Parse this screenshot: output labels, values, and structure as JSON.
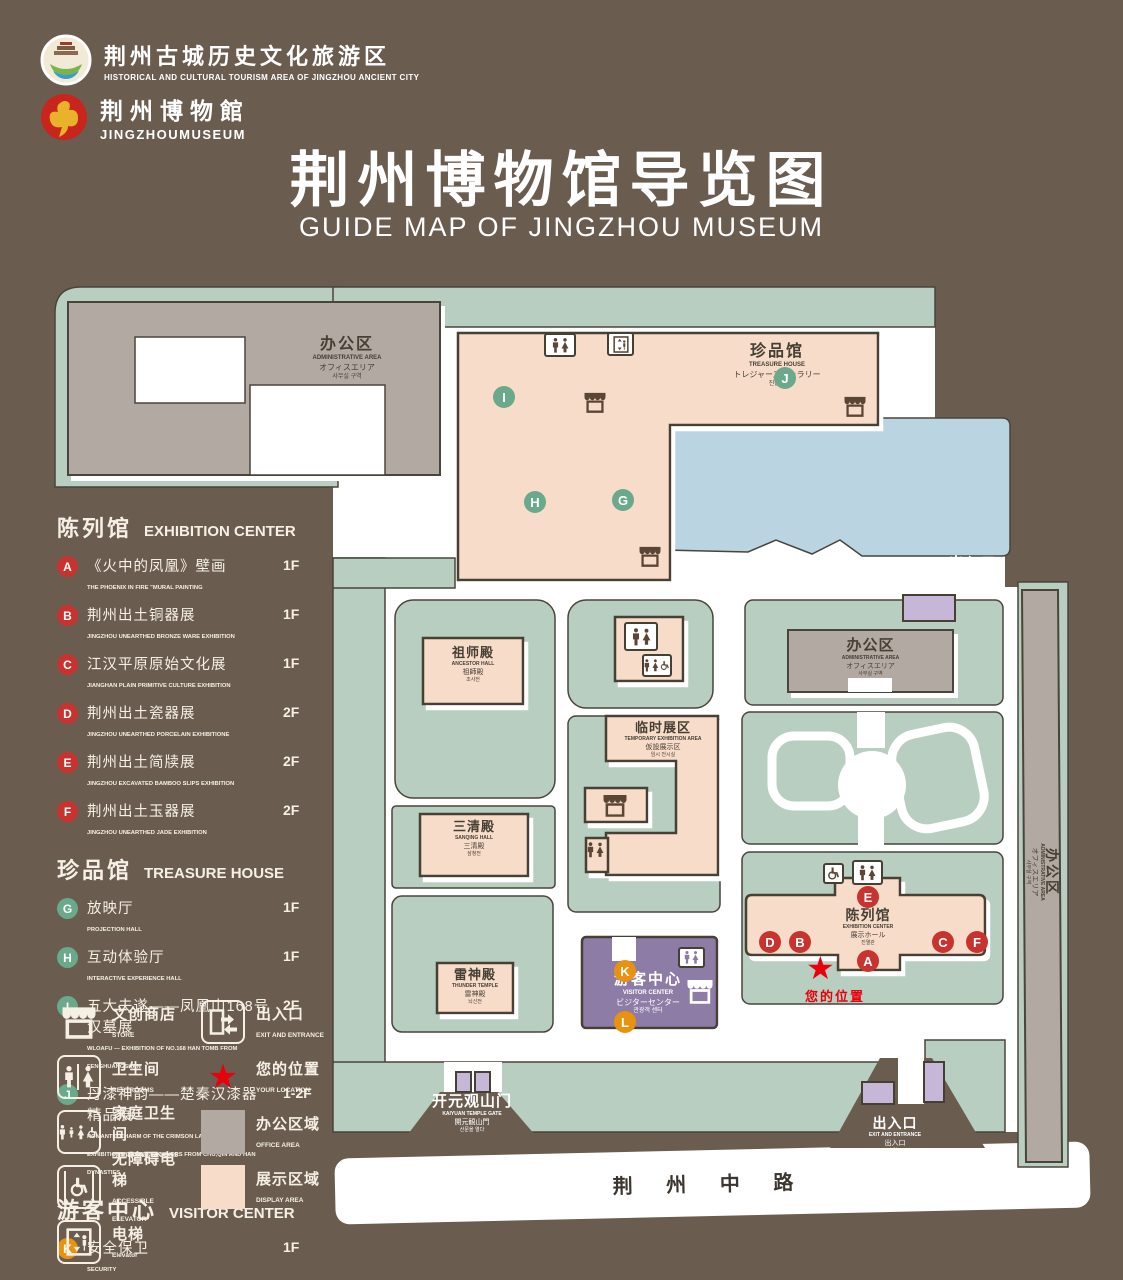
{
  "colors": {
    "background": "#6b5c50",
    "map_green": "#b7cec0",
    "display_pink": "#f8dcca",
    "office_gray": "#b2aaa2",
    "lake_blue": "#bad4e2",
    "visitor_purple": "#8d7ba6",
    "light_purple": "#c6b6d8",
    "badge_red": "#c8332f",
    "badge_green": "#6aa98b",
    "badge_orange": "#e8920f",
    "star_red": "#e8000d",
    "text_cream": "#f6f0e4"
  },
  "header": {
    "logo1_title": "荆州古城历史文化旅游区",
    "logo1_sub": "HISTORICAL AND CULTURAL TOURISM AREA OF JINGZHOU ANCIENT CITY",
    "logo2_title": "荆州博物館",
    "logo2_sub": "JINGZHOUMUSEUM",
    "title": "荆州博物馆导览图",
    "subtitle": "GUIDE MAP OF JINGZHOU MUSEUM"
  },
  "legend": {
    "sections": [
      {
        "zh": "陈列馆",
        "en": "EXHIBITION CENTER",
        "items": [
          {
            "key": "A",
            "zh": "《火中的凤凰》壁画",
            "en": "THE PHOENIX IN FIRE \"MURAL PAINTING",
            "floor": "1F"
          },
          {
            "key": "B",
            "zh": "荆州出土铜器展",
            "en": "JINGZHOU UNEARTHED BRONZE WARE EXHIBITION",
            "floor": "1F"
          },
          {
            "key": "C",
            "zh": "江汉平原原始文化展",
            "en": "JIANGHAN PLAIN PRIMITIVE CULTURE EXHIBITION",
            "floor": "1F"
          },
          {
            "key": "D",
            "zh": "荆州出土瓷器展",
            "en": "JINGZHOU UNEARTHED PORCELAIN EXHIBITIONE",
            "floor": "2F"
          },
          {
            "key": "E",
            "zh": "荆州出土简牍展",
            "en": "JINGZHOU EXCAVATED BAMBOO SLIPS EXHIBITION",
            "floor": "2F"
          },
          {
            "key": "F",
            "zh": "荆州出土玉器展",
            "en": "JINGZHOU UNEARTHED JADE EXHIBITION",
            "floor": "2F"
          }
        ]
      },
      {
        "zh": "珍品馆",
        "en": "TREASURE HOUSE",
        "items": [
          {
            "key": "G",
            "zh": "放映厅",
            "en": "PROJECTION HALL",
            "floor": "1F"
          },
          {
            "key": "H",
            "zh": "互动体验厅",
            "en": "INTERACTIVE EXPERIENCE HALL",
            "floor": "1F"
          },
          {
            "key": "I",
            "zh": "五大夫遂——凤凰山168号汉墓展",
            "en": "WLOAFU — EXHIBITION OF NO.168 HAN TOMB FROM FENGHUANGSHAN",
            "floor": "2F"
          },
          {
            "key": "J",
            "zh": "丹漆神韵——楚秦汉漆器精品展",
            "en": "ROMANTIC CHARM OF THE CRIMSON LACQUERS — EXHIBITIONS OF FINE LACQUERS FROM CHU,QIN AND HAN DYNASTIES",
            "floor": "1-2F"
          }
        ]
      },
      {
        "zh": "游客中心",
        "en": "VISITOR CENTER",
        "items": [
          {
            "key": "K",
            "zh": "安全保卫",
            "en": "SECURITY",
            "floor": "1F"
          },
          {
            "key": "L",
            "zh": "医疗点",
            "en": "CLINIC",
            "floor": "1F"
          }
        ]
      }
    ],
    "pictos": [
      {
        "zh": "文创商店",
        "en": "STORE",
        "icon": "store-icon"
      },
      {
        "zh": "卫生间",
        "en": "RESTROOMS",
        "icon": "restroom-icon"
      },
      {
        "zh": "家庭卫生间",
        "en": "FAMILY RESTROONS",
        "icon": "family-restroom-icon"
      },
      {
        "zh": "无障碍电梯",
        "en": "ACCESSIBLE ELEVATOR",
        "icon": "accessible-elevator-icon"
      },
      {
        "zh": "电梯",
        "en": "Elevator",
        "icon": "elevator-icon"
      },
      {
        "zh": "出入口",
        "en": "EXIT AND ENTRANCE",
        "icon": "exit-door-icon"
      },
      {
        "zh": "您的位置",
        "en": "YOUR LOCATION",
        "icon": "location-star-icon"
      },
      {
        "zh": "办公区域",
        "en": "OFFICE AREA",
        "icon": "office-swatch"
      },
      {
        "zh": "展示区域",
        "en": "DISPLAY AREA",
        "icon": "display-swatch"
      }
    ]
  },
  "map": {
    "admin": {
      "zh": "办公区",
      "en": "ADMINISTRATIVE AREA",
      "ja": "オフィスエリア",
      "ko": "사무실 구역"
    },
    "treasure": {
      "zh": "珍品馆",
      "en": "TREASURE HOUSE",
      "ja": "トレジャーズギャラリー",
      "ko": "진품관"
    },
    "ancestor": {
      "zh": "祖师殿",
      "en": "ANCESTOR HALL",
      "ja": "祖師殿",
      "ko": "조사전"
    },
    "sanqing": {
      "zh": "三清殿",
      "en": "SANQING HALL",
      "ja": "三清殿",
      "ko": "삼청전"
    },
    "temporary": {
      "zh": "临时展区",
      "en": "TEMPORARY EXHIBITION AREA",
      "ja": "仮設展示区",
      "ko": "임시 전시실"
    },
    "thunder": {
      "zh": "雷神殿",
      "en": "THUNDER TEMPLE",
      "ja": "雷神殿",
      "ko": "뇌신전"
    },
    "visitor": {
      "zh": "游客中心",
      "en": "VISITOR CENTER",
      "ja": "ビジターセンター",
      "ko": "관광객 센터"
    },
    "exhibition": {
      "zh": "陈列馆",
      "en": "EXHIBITION CENTER",
      "ja": "展示ホール",
      "ko": "진열관"
    },
    "exit": {
      "zh": "出入口",
      "en": "EXIT AND ENTRANCE",
      "ja": "出入口",
      "ko": "출입구"
    },
    "gate": {
      "zh": "开元观山门",
      "en": "KAIYUAN TEMPLE GATE",
      "ja": "開元観山門",
      "ko": "산문을 열다"
    },
    "road": "荆 州 中 路",
    "your_location": "您的位置",
    "letters": {
      "A": "A",
      "B": "B",
      "C": "C",
      "D": "D",
      "E": "E",
      "F": "F",
      "G": "G",
      "H": "H",
      "I": "I",
      "J": "J",
      "K": "K",
      "L": "L"
    }
  }
}
